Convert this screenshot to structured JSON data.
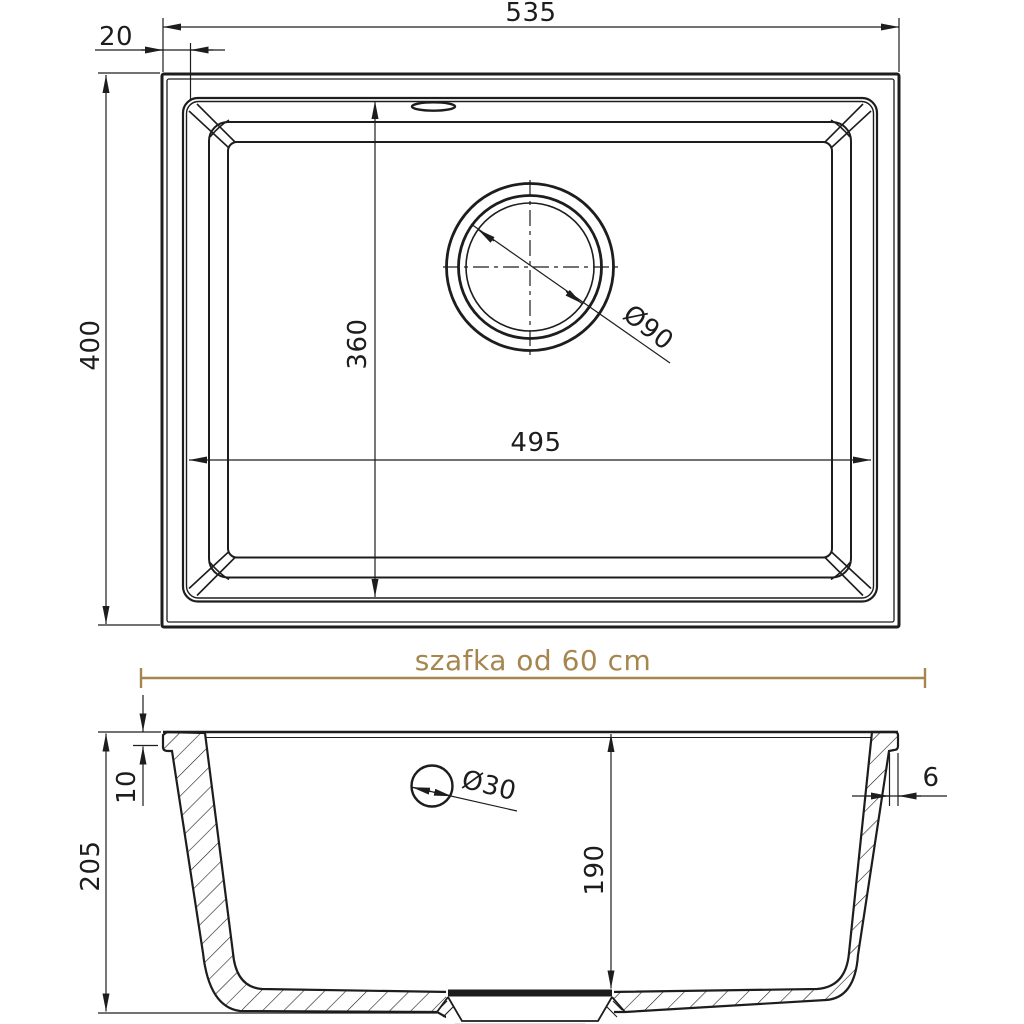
{
  "colors": {
    "line": "#1d1d1d",
    "gold": "#a6864f"
  },
  "top_view": {
    "name": "sink top view",
    "dims": {
      "total_width": "535",
      "rim_offset": "20",
      "outer_depth": "400",
      "bowl_depth": "360",
      "bowl_width": "495",
      "drain_diameter": "Ø90"
    }
  },
  "section_view": {
    "name": "sink cross-section view",
    "cabinet_note": "szafka od 60 cm",
    "dims": {
      "total_height": "205",
      "rim_height": "10",
      "bowl_inner_depth": "190",
      "wall_thickness": "6",
      "tap_hole_diameter": "Ø30"
    }
  }
}
